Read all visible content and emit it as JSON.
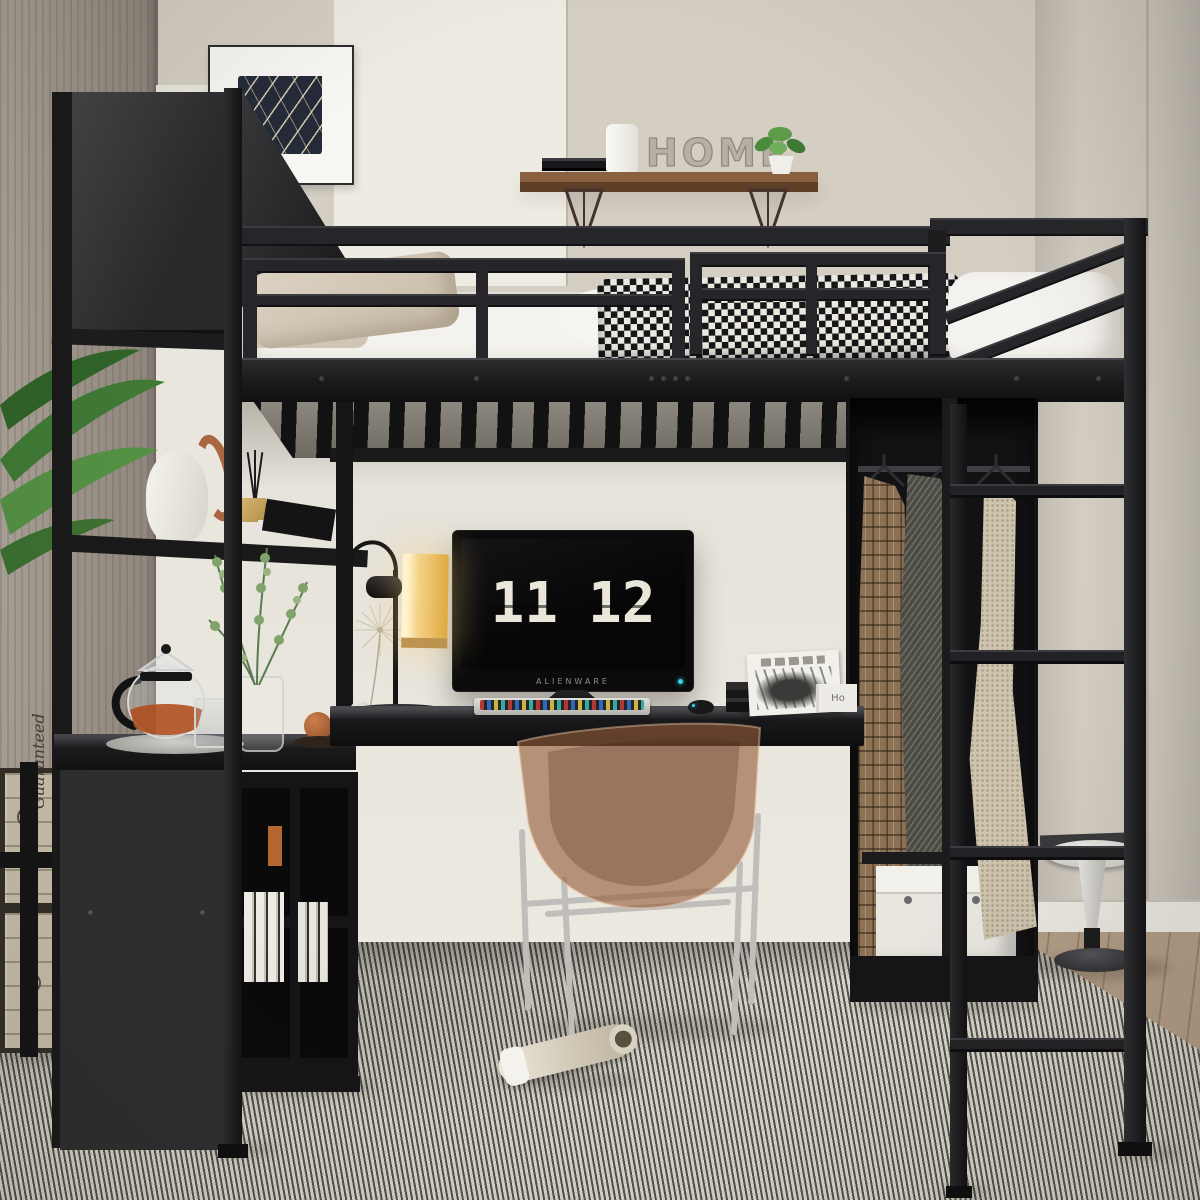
{
  "wall_decor": {
    "home_sign_text": "HOME"
  },
  "desk": {
    "monitor": {
      "brand": "ALIENWARE",
      "clock_hours": "11",
      "clock_minutes": "12"
    },
    "book_spine_text": "Ho"
  },
  "crates": {
    "stamp_text": "Guaranteed"
  },
  "palette": {
    "wall_greige": "#d4cec3",
    "frame_black": "#1d1d1f",
    "shelf_wood": "#8a6140",
    "chair_amber": "#95593a",
    "lamp_glow": "#f2cd7e",
    "tea_amber": "#b1501e",
    "rug_light": "#d8d5cc",
    "rug_dark": "#55524b",
    "stool_white": "#e8e7e3",
    "led_cyan": "#35d4e8",
    "houndstooth_dark": "#17171a",
    "houndstooth_light": "#ece9e2"
  },
  "objects": [
    "black-metal-loft-bed",
    "guardrail",
    "bed-slats",
    "ladder",
    "wardrobe",
    "hanging-coats",
    "desk",
    "gaming-monitor",
    "flip-clock-screensaver",
    "rgb-keyboard",
    "mouse",
    "desk-lamp",
    "acrylic-chair",
    "shelving-tower",
    "teapot",
    "glass-cup",
    "eucalyptus-vase",
    "tulip-stool",
    "storage-box",
    "wall-shelf",
    "home-sign",
    "framed-art",
    "striped-rug",
    "wood-crates",
    "rolled-magazine",
    "palm-plant",
    "houndstooth-blanket",
    "pillows",
    "cube-bookshelf"
  ]
}
